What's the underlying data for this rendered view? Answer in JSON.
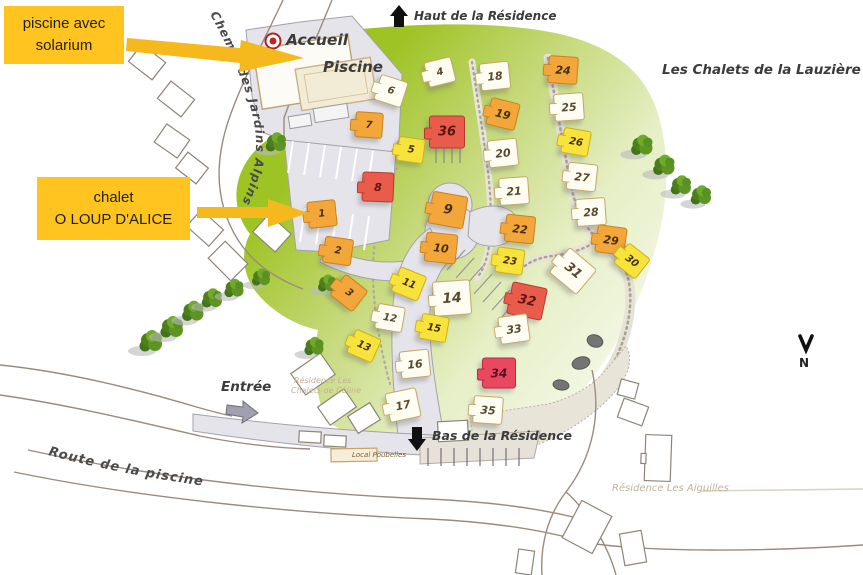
{
  "title": "Les Chalets de la Lauzière",
  "callouts": {
    "pool": {
      "line1": "piscine avec",
      "line2": "solarium"
    },
    "chalet": {
      "line1": "chalet",
      "line2": "O LOUP D'ALICE"
    }
  },
  "labels": {
    "accueil": "Accueil",
    "piscine": "Piscine",
    "haut": "Haut de la Résidence",
    "bas": "Bas de la Résidence",
    "entree": "Entrée",
    "local_poubelles": "Local Poubelles",
    "residence_aiguilles": "Résidence Les Aiguilles",
    "residence_ecrin_l1": "Résidence Les",
    "residence_ecrin_l2": "Chalets de Céline",
    "route_piscine": "Route de la piscine",
    "chemin_jardins": "Chemin des Jardins Alpins",
    "compass_n": "N"
  },
  "colors": {
    "callout_bg": "#FFC41F",
    "arrow_yellow": "#F5B91E",
    "chalet_orange": "#F3A63A",
    "chalet_yellow": "#F8E23C",
    "chalet_red": "#E95C4C",
    "chalet_crimson": "#EA4760",
    "chalet_white": "#FFFDF2",
    "green_area": "#A4C52F",
    "road_gray": "#E4E4EA"
  },
  "chalets": [
    {
      "num": 1,
      "x": 322,
      "y": 214,
      "color": "orange",
      "rot": -6,
      "size": 27
    },
    {
      "num": 2,
      "x": 338,
      "y": 251,
      "color": "orange",
      "rot": 8,
      "size": 27
    },
    {
      "num": 3,
      "x": 349,
      "y": 293,
      "color": "orange",
      "rot": 38,
      "size": 27
    },
    {
      "num": 4,
      "x": 440,
      "y": 72,
      "color": "white",
      "rot": -14,
      "size": 26
    },
    {
      "num": 5,
      "x": 411,
      "y": 150,
      "color": "yellow",
      "rot": 8,
      "size": 25
    },
    {
      "num": 6,
      "x": 391,
      "y": 91,
      "color": "white",
      "rot": 18,
      "size": 27
    },
    {
      "num": 7,
      "x": 369,
      "y": 125,
      "color": "orange",
      "rot": 4,
      "size": 26
    },
    {
      "num": 8,
      "x": 378,
      "y": 187,
      "color": "red",
      "rot": 2,
      "size": 30
    },
    {
      "num": 9,
      "x": 448,
      "y": 210,
      "color": "orange",
      "rot": 10,
      "size": 34
    },
    {
      "num": 10,
      "x": 441,
      "y": 248,
      "color": "orange",
      "rot": 6,
      "size": 30
    },
    {
      "num": 11,
      "x": 409,
      "y": 284,
      "color": "yellow",
      "rot": 22,
      "size": 27
    },
    {
      "num": 12,
      "x": 390,
      "y": 318,
      "color": "white",
      "rot": 10,
      "size": 26
    },
    {
      "num": 13,
      "x": 364,
      "y": 346,
      "color": "yellow",
      "rot": 24,
      "size": 26
    },
    {
      "num": 14,
      "x": 452,
      "y": 298,
      "color": "white",
      "rot": -4,
      "size": 36
    },
    {
      "num": 15,
      "x": 434,
      "y": 328,
      "color": "yellow",
      "rot": 10,
      "size": 26
    },
    {
      "num": 16,
      "x": 415,
      "y": 364,
      "color": "white",
      "rot": -6,
      "size": 28
    },
    {
      "num": 17,
      "x": 403,
      "y": 405,
      "color": "white",
      "rot": -12,
      "size": 30
    },
    {
      "num": 18,
      "x": 495,
      "y": 76,
      "color": "white",
      "rot": -6,
      "size": 28
    },
    {
      "num": 19,
      "x": 503,
      "y": 114,
      "color": "orange",
      "rot": 14,
      "size": 28
    },
    {
      "num": 20,
      "x": 503,
      "y": 153,
      "color": "white",
      "rot": -6,
      "size": 28
    },
    {
      "num": 21,
      "x": 514,
      "y": 191,
      "color": "white",
      "rot": -4,
      "size": 28
    },
    {
      "num": 22,
      "x": 520,
      "y": 229,
      "color": "orange",
      "rot": 6,
      "size": 28
    },
    {
      "num": 23,
      "x": 510,
      "y": 261,
      "color": "yellow",
      "rot": 8,
      "size": 26
    },
    {
      "num": 24,
      "x": 563,
      "y": 70,
      "color": "orange",
      "rot": 4,
      "size": 28
    },
    {
      "num": 25,
      "x": 569,
      "y": 107,
      "color": "white",
      "rot": -4,
      "size": 28
    },
    {
      "num": 26,
      "x": 576,
      "y": 142,
      "color": "yellow",
      "rot": 10,
      "size": 26
    },
    {
      "num": 27,
      "x": 582,
      "y": 177,
      "color": "white",
      "rot": 6,
      "size": 28
    },
    {
      "num": 28,
      "x": 591,
      "y": 212,
      "color": "white",
      "rot": -4,
      "size": 28
    },
    {
      "num": 29,
      "x": 611,
      "y": 240,
      "color": "orange",
      "rot": 8,
      "size": 28
    },
    {
      "num": 30,
      "x": 632,
      "y": 261,
      "color": "yellow",
      "rot": 38,
      "size": 26
    },
    {
      "num": 31,
      "x": 573,
      "y": 271,
      "color": "white",
      "rot": 40,
      "size": 34
    },
    {
      "num": 32,
      "x": 527,
      "y": 301,
      "color": "red",
      "rot": 12,
      "size": 34
    },
    {
      "num": 33,
      "x": 514,
      "y": 329,
      "color": "white",
      "rot": -8,
      "size": 28
    },
    {
      "num": 34,
      "x": 499,
      "y": 373,
      "color": "crimson",
      "rot": 0,
      "size": 32
    },
    {
      "num": 35,
      "x": 488,
      "y": 410,
      "color": "white",
      "rot": 4,
      "size": 28
    },
    {
      "num": 36,
      "x": 447,
      "y": 132,
      "color": "red",
      "rot": 0,
      "size": 34
    }
  ]
}
